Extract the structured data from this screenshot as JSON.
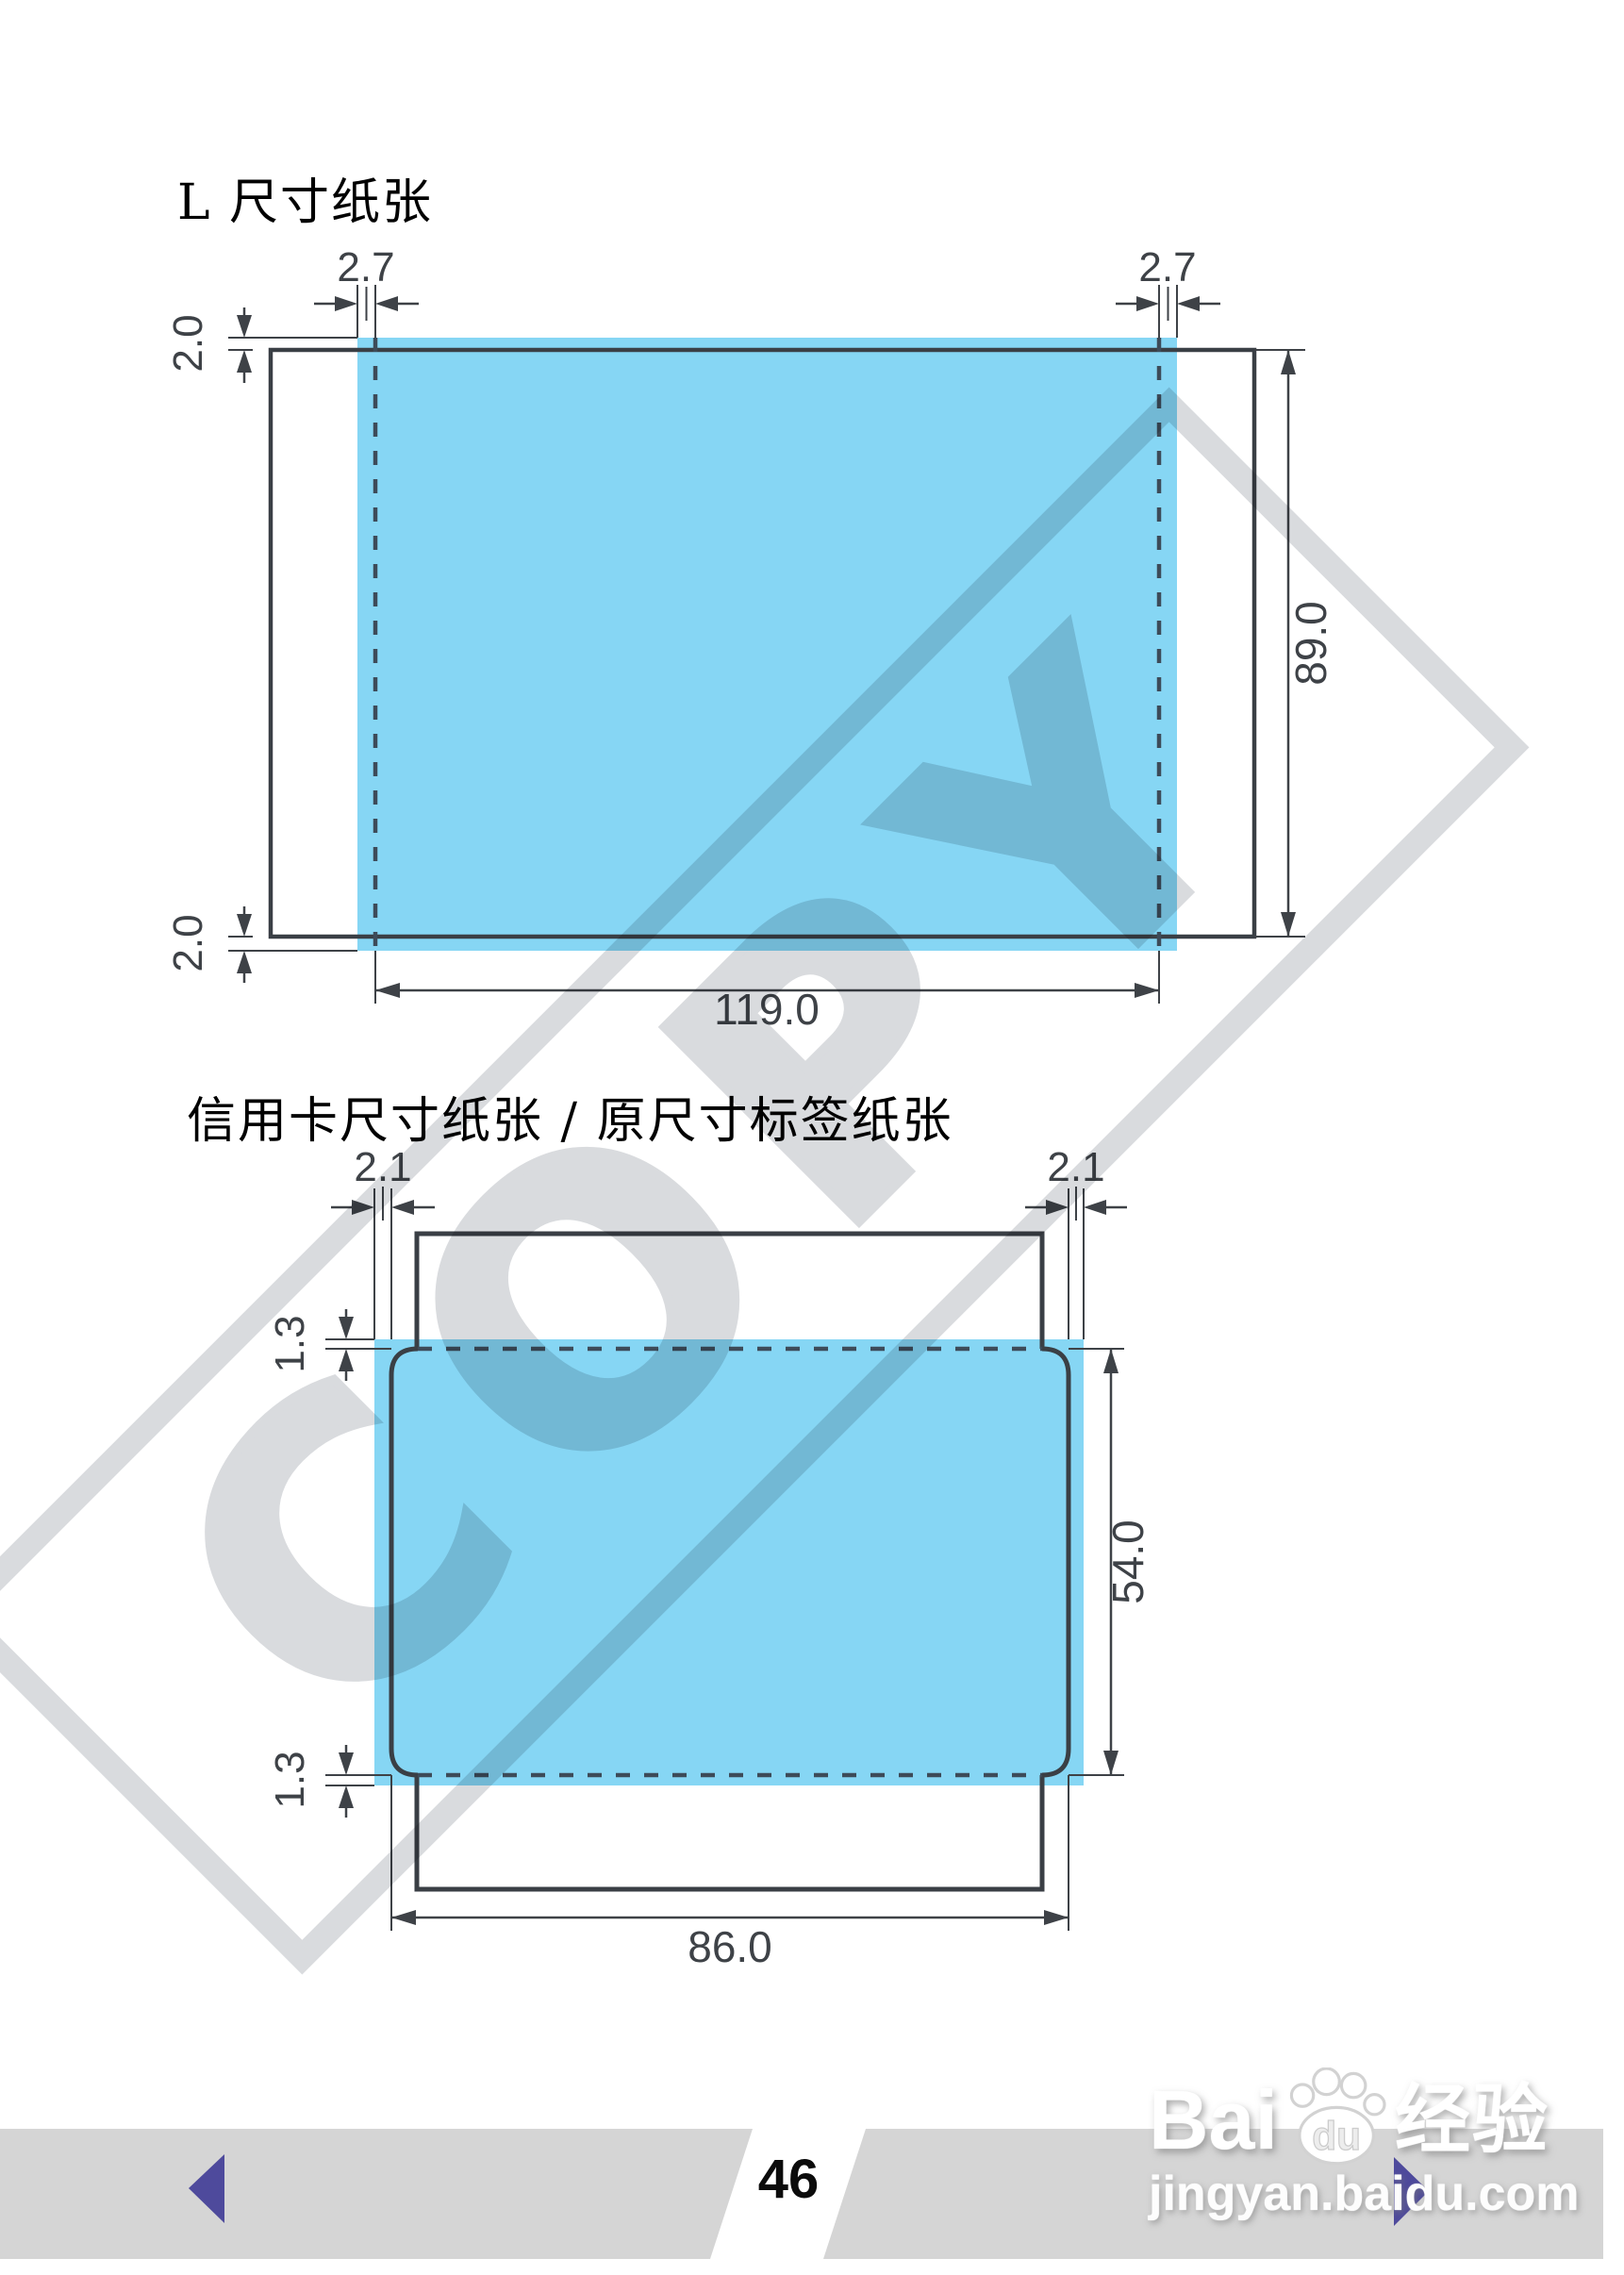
{
  "watermark": {
    "text": "COPY",
    "color": "#d9dbde"
  },
  "diagram1": {
    "title": "L 尺寸纸张",
    "labels": {
      "top_left": "2.7",
      "top_right": "2.7",
      "left_top": "2.0",
      "left_bottom": "2.0",
      "height": "89.0",
      "width": "119.0"
    }
  },
  "diagram2": {
    "title": "信用卡尺寸纸张 / 原尺寸标签纸张",
    "labels": {
      "top_left": "2.1",
      "top_right": "2.1",
      "left_top": "1.3",
      "left_bottom": "1.3",
      "height": "54.0",
      "width": "86.0"
    }
  },
  "footer": {
    "page_number": "46"
  },
  "branding": {
    "name_prefix": "Bai",
    "name_paw": "du",
    "name_suffix": "经验",
    "url": "jingyan.baidu.com"
  },
  "colors": {
    "print_area_blue": "#86d6f4",
    "line_dark": "#3a3f45",
    "dash_line": "#3d4b59",
    "dimension_text": "#3e4247",
    "footer_band_gray": "#d5d5d5",
    "nav_arrow_purple": "#4e4a9c",
    "watermark_gray": "#d9dbde"
  }
}
